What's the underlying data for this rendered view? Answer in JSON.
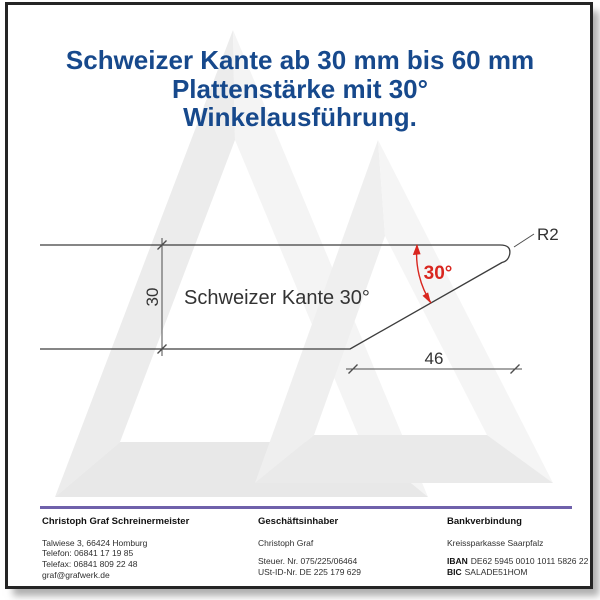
{
  "title": {
    "line1": "Schweizer Kante ab 30 mm bis 60 mm",
    "line2": "Plattenstärke mit 30°",
    "line3": "Winkelausführung.",
    "color": "#17498c"
  },
  "drawing": {
    "profile_label": "Schweizer Kante 30°",
    "thickness_dim": "30",
    "width_dim": "46",
    "angle_label": "30°",
    "radius_label": "R2",
    "angle_color": "#d9261f",
    "line_color": "#3d3d3d",
    "dim_color": "#4d4d4d"
  },
  "watermark": {
    "description": "light gray double-triangle company logo",
    "color": "#ececec"
  },
  "footer": {
    "separator_color": "#6f61ab",
    "company": {
      "heading": "Christoph Graf Schreinermeister",
      "address": "Talwiese 3, 66424 Homburg",
      "phone": "Telefon: 06841 17 19 85",
      "fax": "Telefax: 06841 809 22 48",
      "email": "graf@grafwerk.de"
    },
    "owner": {
      "heading": "Geschäftsinhaber",
      "name": "Christoph Graf",
      "tax_no": "Steuer. Nr. 075/225/06464",
      "vat_no": "USt-ID-Nr. DE 225 179 629"
    },
    "bank": {
      "heading": "Bankverbindung",
      "bank_name": "Kreissparkasse Saarpfalz",
      "iban_label": "IBAN",
      "iban": "DE62 5945 0010 1011 5826 22",
      "bic_label": "BIC",
      "bic": "SALADE51HOM"
    }
  }
}
